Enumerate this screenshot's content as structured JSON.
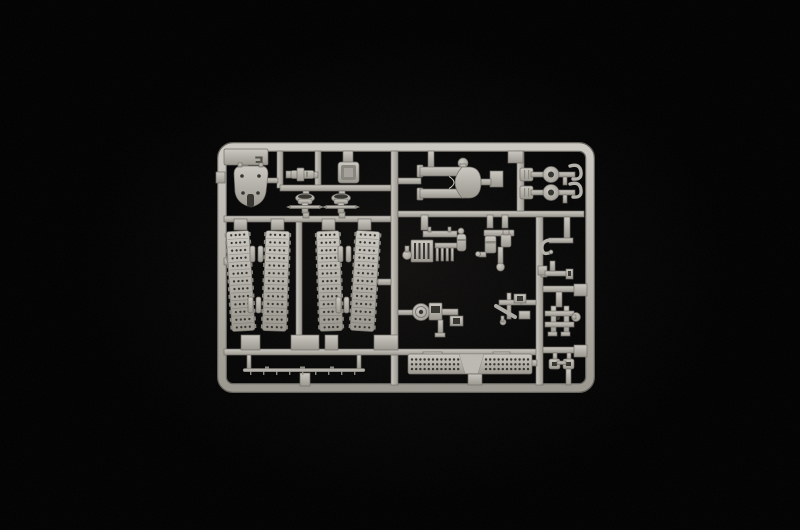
{
  "scene": {
    "subject": "Photograph of a light grey injection-moulded model kit sprue (parts frame) centered on a black background",
    "background_color": "#000000",
    "plastic_highlight": "#cac7c0",
    "plastic_mid": "#b1aea7",
    "plastic_shadow": "#6f6c65",
    "detail_dark": "#34332e",
    "sprue_letter": "E"
  },
  "parts": [
    {
      "id": "sprue-frame",
      "label": "rectangular runner frame with rounded corners and internal rails"
    },
    {
      "id": "letter-tag-plate",
      "label": "flat tab moulded with the sprue letter"
    },
    {
      "id": "gun-mantlet",
      "label": "curved shield plate with four rivet holes and a central slot"
    },
    {
      "id": "gun-muzzle",
      "label": "small stepped muzzle cylinder"
    },
    {
      "id": "stowage-box",
      "label": "open-topped square box"
    },
    {
      "id": "suspension-brackets",
      "label": "two winged suspension brackets with cross axles"
    },
    {
      "id": "gun-cradle-fork",
      "label": "forked gun cradle with ball knob"
    },
    {
      "id": "machine-guns",
      "label": "two machine guns with drum magazines and curved handles"
    },
    {
      "id": "track-runs",
      "label": "four perforated track-link runs in two pairs"
    },
    {
      "id": "engine-assembly",
      "label": "slatted engine block with round filter"
    },
    {
      "id": "cylinder-assembly",
      "label": "twin cylinders with rod and foot"
    },
    {
      "id": "wheel-pump-assembly",
      "label": "road wheel with pump housing"
    },
    {
      "id": "linkage-cluster",
      "label": "small linkage and fittings cluster"
    },
    {
      "id": "tow-hook",
      "label": "curved towing hook"
    },
    {
      "id": "step-bracket",
      "label": "stepped footboard bracket"
    },
    {
      "id": "clamp-frame",
      "label": "twin-post clamp frame with ball end"
    },
    {
      "id": "shackle-eyes",
      "label": "two square shackle eyes"
    },
    {
      "id": "engine-deck",
      "label": "long perforated engine deck plate"
    },
    {
      "id": "tow-cable",
      "label": "thin tow cable with fittings"
    }
  ]
}
